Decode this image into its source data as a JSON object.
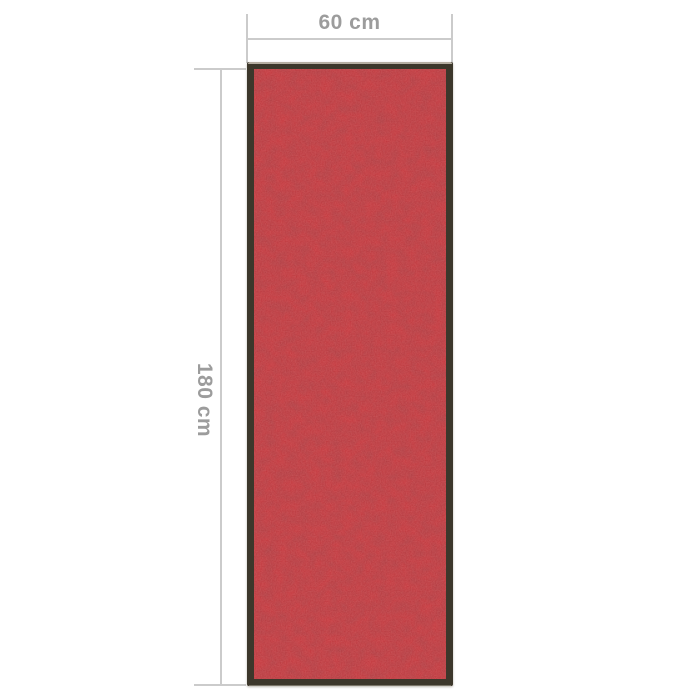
{
  "diagram": {
    "background_color": "#ffffff",
    "subject": "doormat"
  },
  "dimensions": {
    "width": {
      "label": "60 cm"
    },
    "height": {
      "label": "180 cm"
    },
    "line_color": "#cbcbcb",
    "label_color": "#9c9c9c"
  },
  "mat": {
    "fill_color": "#c5343a",
    "shade_color_dark": "#521014",
    "border_color": "#3c372b",
    "top_highlight_color": "#b5aea2"
  }
}
